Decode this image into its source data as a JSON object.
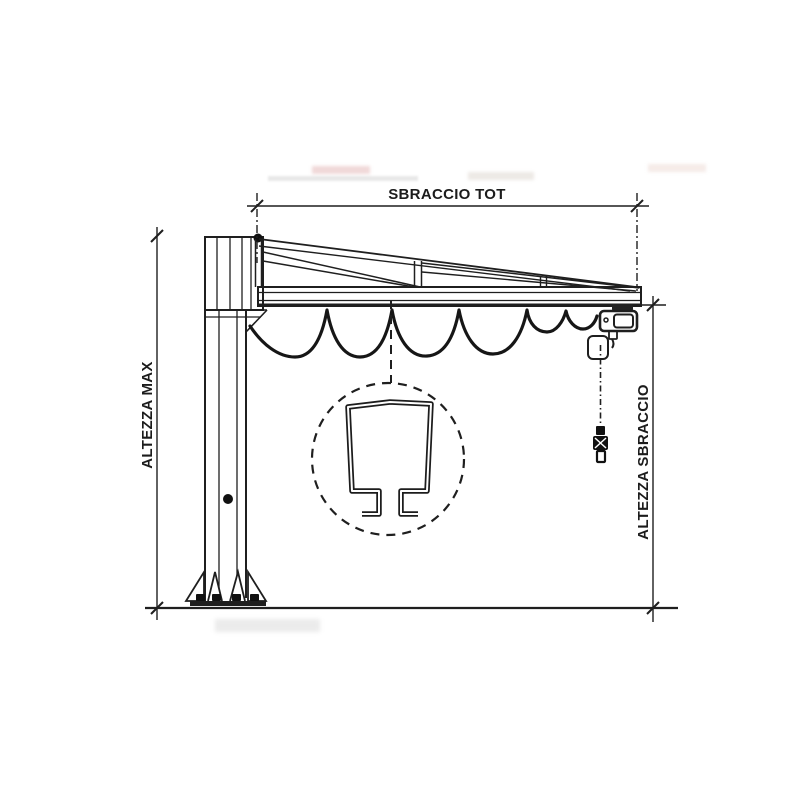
{
  "figure": {
    "type": "technical-drawing",
    "subject": "jib crane side elevation"
  },
  "labels": {
    "top_dimension": "SBRACCIO TOT",
    "left_dimension": "ALTEZZA MAX",
    "right_dimension": "ALTEZZA SBRACCIO"
  },
  "colors": {
    "line": "#1f1f1f",
    "background": "#ffffff"
  }
}
